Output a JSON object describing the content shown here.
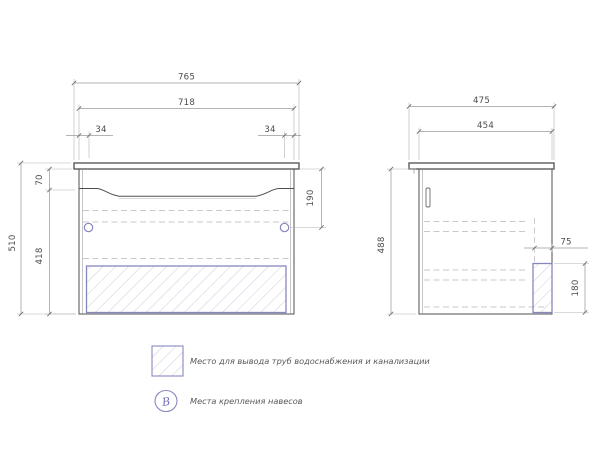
{
  "front_view": {
    "dims": {
      "overall_width": "765",
      "cabinet_width": "718",
      "hole_offset_left": "34",
      "hole_offset_right": "34",
      "countertop_to_front": "70",
      "body_height": "418",
      "overall_height": "510",
      "hole_from_top": "190"
    }
  },
  "side_view": {
    "dims": {
      "overall_depth": "475",
      "cabinet_depth": "454",
      "body_height": "488",
      "pipe_zone_depth": "75",
      "pipe_zone_height": "180"
    }
  },
  "legend": {
    "items": [
      {
        "symbol": "pipe-hatch-square",
        "label": "Место для вывода труб водоснабжения и канализации"
      },
      {
        "symbol": "hanger-circle",
        "symbol_text": "В",
        "label": "Места крепления навесов"
      }
    ]
  },
  "colors": {
    "outline": "#4f4f4f",
    "dimension_line": "#9a9a9a",
    "accent_blue": "#8787bf",
    "hatch_line": "#ccccdf",
    "text": "#4d4d4d"
  }
}
